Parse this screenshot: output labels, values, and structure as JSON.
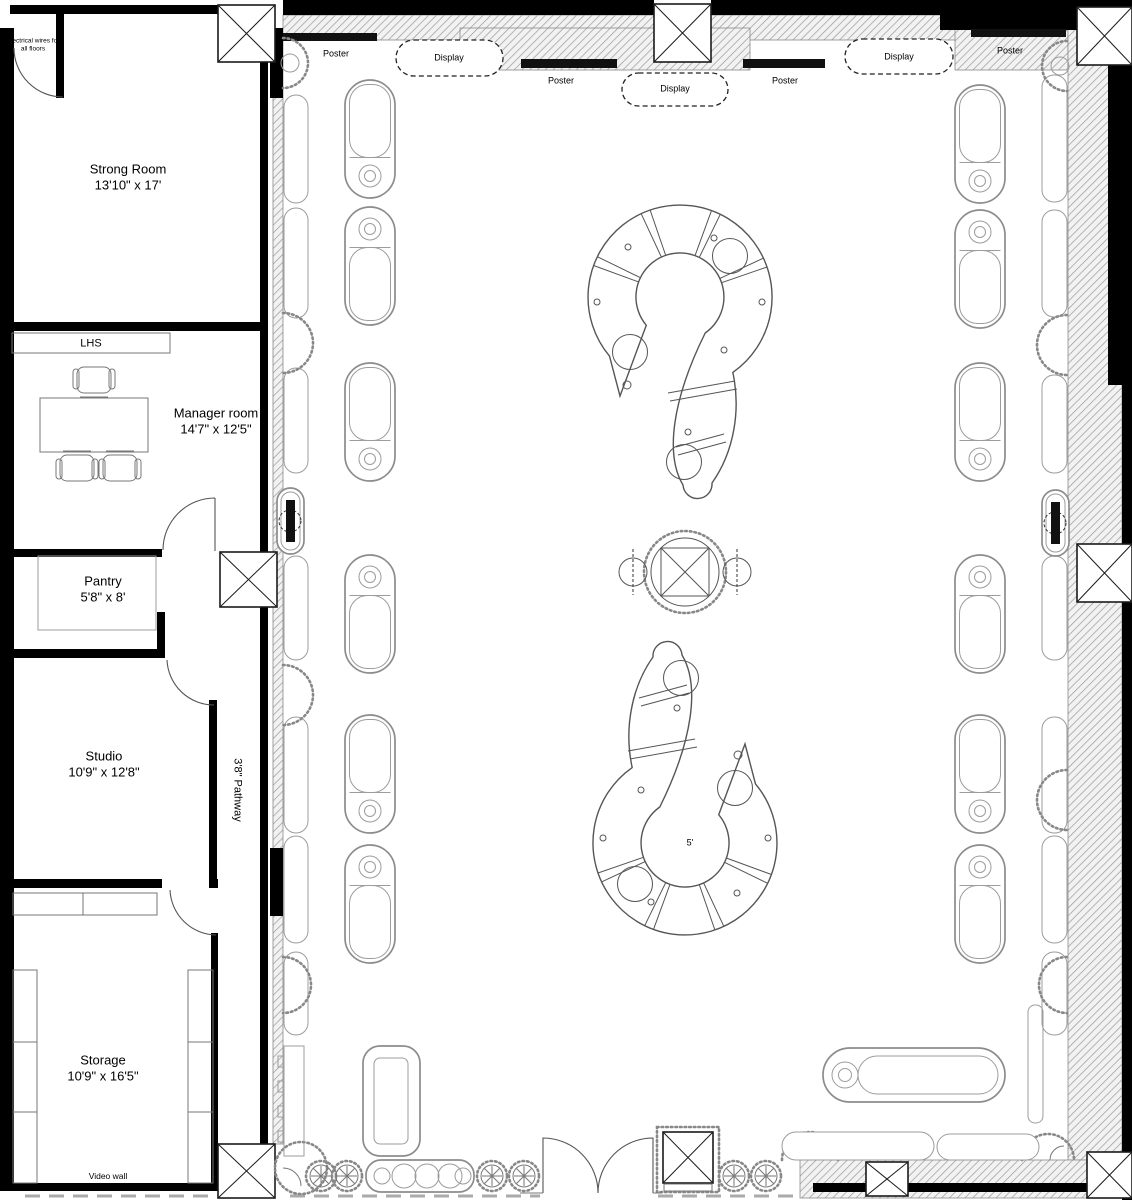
{
  "title": "Retail store floor plan",
  "colors": {
    "wall": "#000000",
    "hatch_line": "#8a8a8a",
    "fixture_line": "#8c8c8c",
    "background": "#ffffff"
  },
  "rooms": {
    "strong_room": {
      "name": "Strong Room",
      "dims": "13'10\" x 17'"
    },
    "manager_room": {
      "name": "Manager room",
      "dims": "14'7\" x 12'5\""
    },
    "pantry": {
      "name": "Pantry",
      "dims": "5'8\" x 8'"
    },
    "studio": {
      "name": "Studio",
      "dims": "10'9\" x 12'8\""
    },
    "storage": {
      "name": "Storage",
      "dims": "10'9\" x 16'5\""
    }
  },
  "annotations": {
    "electrical_note": "Electrical wires for all floors",
    "shelf_label": "LHS",
    "pathway": "3'8\" Pathway",
    "video_wall": "Video wall",
    "aisle_width": "5'"
  },
  "wall_labels": {
    "poster": "Poster",
    "display": "Display"
  }
}
